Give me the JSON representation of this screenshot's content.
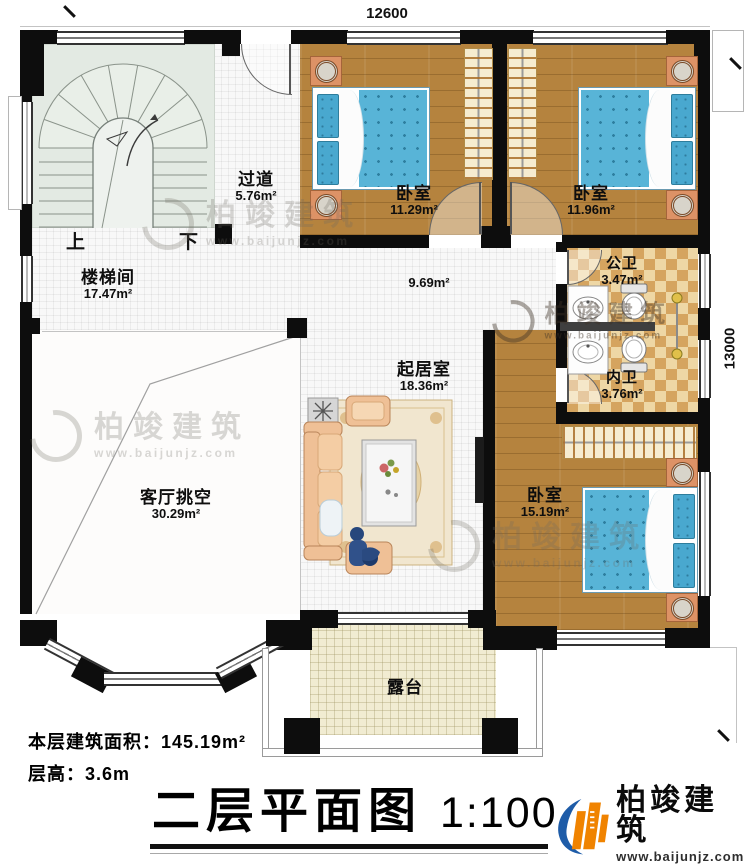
{
  "plan": {
    "dimensions": {
      "top": "12600",
      "right": "13000"
    },
    "rooms": {
      "corridor": {
        "name": "过道",
        "area": "5.76m²"
      },
      "bedroom_tl": {
        "name": "卧室",
        "area": "11.29m²"
      },
      "bedroom_tr": {
        "name": "卧室",
        "area": "11.96m²"
      },
      "public_bath": {
        "name": "公卫",
        "area": "3.47m²"
      },
      "inner_bath": {
        "name": "内卫",
        "area": "3.76m²"
      },
      "stair_hall": {
        "name": "楼梯间",
        "area": "17.47m²"
      },
      "hallway": {
        "area": "9.69m²"
      },
      "living": {
        "name": "起居室",
        "area": "18.36m²"
      },
      "void": {
        "name": "客厅挑空",
        "area": "30.29m²"
      },
      "bedroom_br": {
        "name": "卧室",
        "area": "15.19m²"
      },
      "terrace": {
        "name": "露台"
      }
    },
    "stairs": {
      "up": "上",
      "down": "下"
    }
  },
  "footer": {
    "floor_area_label": "本层建筑面积：",
    "floor_area_value": "145.19m²",
    "floor_height_label": "层高：",
    "floor_height_value": "3.6m",
    "title": "二层平面图",
    "scale": "1:100"
  },
  "brand": {
    "name": "柏竣建筑",
    "website": "www.baijunjz.com"
  },
  "watermark": {
    "name": "柏竣建筑",
    "website": "www.baijunjz.com"
  },
  "colors": {
    "wall": "#0d0d0d",
    "wood": "#b5833e",
    "bed_blue": "#58b4d7",
    "tile_tan": "#d5a45f",
    "accent_orange": "#f08300",
    "accent_blue": "#1e5ca8"
  }
}
